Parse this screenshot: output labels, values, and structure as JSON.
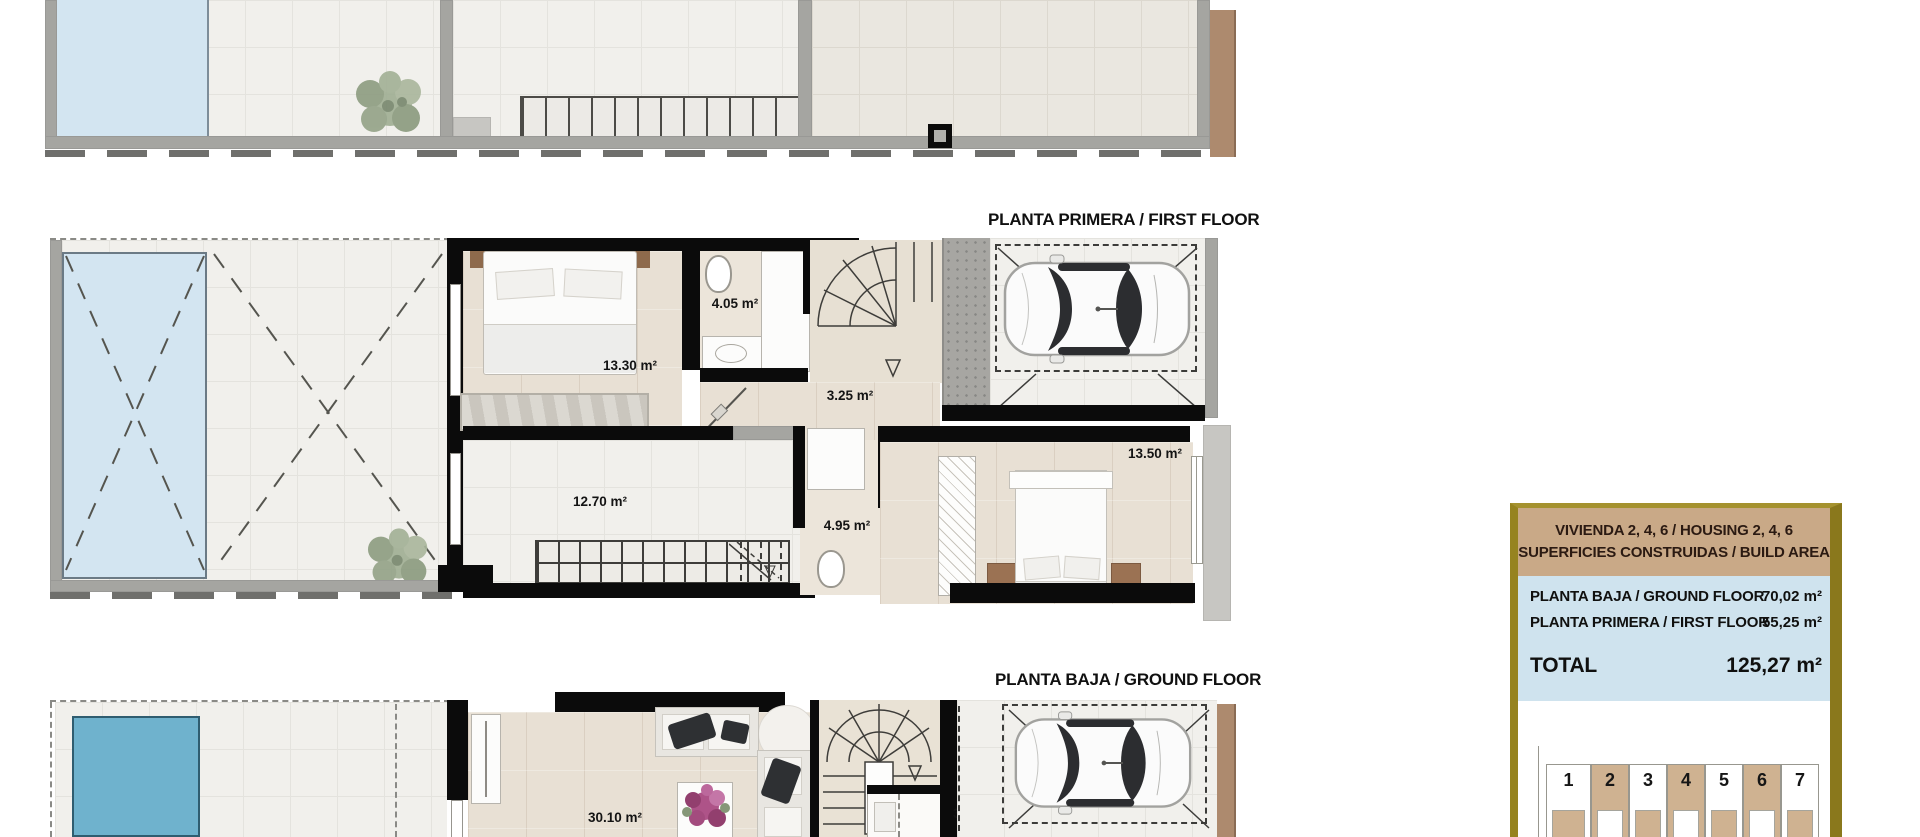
{
  "floor_plans": {
    "first_floor": {
      "title": "PLANTA PRIMERA / FIRST FLOOR",
      "areas": {
        "bedroom1": "13.30 m²",
        "bathroom1": "4.05 m²",
        "hallway": "3.25 m²",
        "bedroom3": "12.70 m²",
        "bathroom2": "4.95 m²",
        "bedroom2": "13.50 m²"
      }
    },
    "ground_floor": {
      "title": "PLANTA BAJA / GROUND FLOOR",
      "areas": {
        "living_room": "30.10 m²",
        "storage": "3.00 m²"
      }
    }
  },
  "info_panel": {
    "header_line1": "VIVIENDA 2, 4, 6 / HOUSING 2, 4, 6",
    "header_line2": "SUPERFICIES CONSTRUIDAS / BUILD AREA",
    "rows": [
      {
        "label": "PLANTA BAJA / GROUND FLOOR",
        "value": "70,02 m²"
      },
      {
        "label": "PLANTA PRIMERA / FIRST FLOOR",
        "value": "55,25 m²"
      }
    ],
    "total_label": "TOTAL",
    "total_value": "125,27 m²",
    "site_plan_units": [
      "1",
      "2",
      "3",
      "4",
      "5",
      "6",
      "7"
    ],
    "highlighted_units": "2, 4, 6"
  },
  "colors": {
    "frame_gold": "#96831f",
    "header_tan": "#c9a987",
    "panel_blue": "#cfe3ee",
    "pool_light": "#d3e5f1",
    "pool_dark": "#6fb2cd",
    "unit_highlight": "#cfb291"
  }
}
